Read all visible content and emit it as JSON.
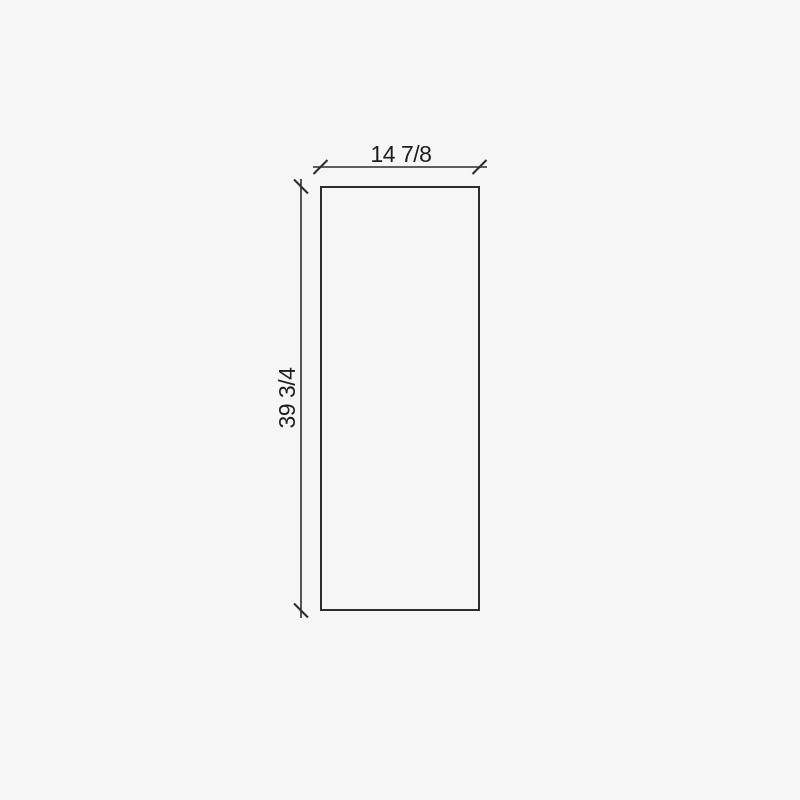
{
  "drawing": {
    "title": "panel-elevation-drawing",
    "dimensions": {
      "width": {
        "label": "14 7/8"
      },
      "height": {
        "label": "39 3/4"
      }
    },
    "colors": {
      "background": "#f6f6f6",
      "line": "#2c2c2c",
      "text": "#1d1d1d"
    }
  }
}
